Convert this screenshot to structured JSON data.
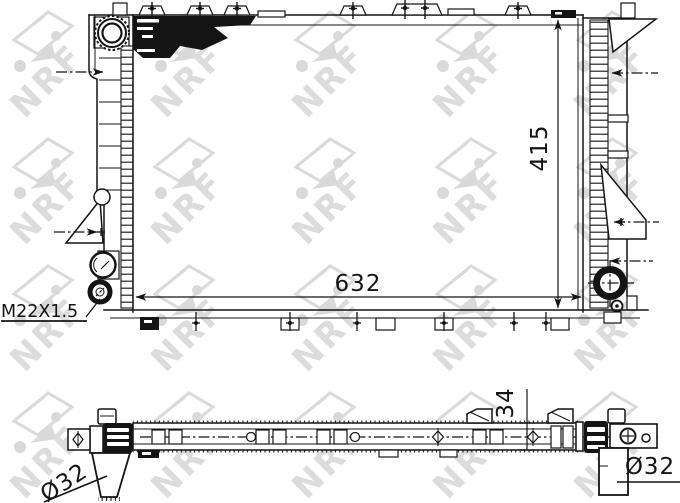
{
  "watermark": {
    "text": "NRF"
  },
  "drawing": {
    "front_view": {
      "width_dim": "632",
      "height_dim": "415",
      "drain_plug_thread": "M22X1.5"
    },
    "side_view": {
      "depth_dim": "34",
      "inlet_diameter": "Ø32",
      "outlet_diameter": "Ø32"
    },
    "colors": {
      "line": "#141414",
      "background": "#ffffff",
      "watermark": "#d9d9d9"
    }
  }
}
